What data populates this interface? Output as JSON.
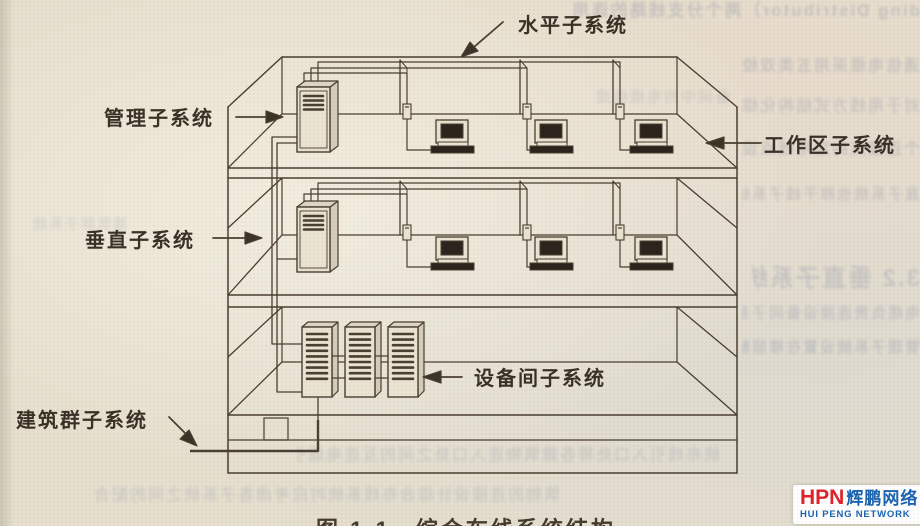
{
  "page": {
    "paper_color": "#e6dfce",
    "ink_color": "#4a3e31",
    "dark_fill": "#2b241c"
  },
  "diagram": {
    "caption": "图 1-1　综合布线系统结构",
    "labels": {
      "horizontal_subsystem": "水平子系统",
      "management_subsystem": "管理子系统",
      "work_area_subsystem": "工作区子系统",
      "vertical_subsystem": "垂直子系统",
      "equipment_room_subsystem": "设备间子系统",
      "campus_subsystem": "建筑群子系统"
    }
  },
  "watermark": {
    "abbr": "HPN",
    "name_cn": "辉鹏网络",
    "name_en": "HUI PENG NETWORK",
    "abbr_color": "#e0232a",
    "text_color": "#1b63b0"
  },
  "ghost_lines": [
    "ding Distributor）两个分支线路的连用",
    "通信电缆采用五类双绞线与配线区设备间连",
    "对于用线方式结构化综合布线系统的要求",
    "个连接点约定用线点设备间子系统由设",
    "3.2 垂直子系统",
    "直子系统也称干线子系统是建筑物内的主干",
    "电缆负责连接设备间子系统与楼层配线间",
    "管理子系统设置在楼层配线间是水平电缆汇",
    "备间中的电缆组成",
    "统布线引入口处将各建筑物连入口处之间的互连电缆引出建",
    "筑物的连接设计综合布线系统时应考虑各子系统之间的配合",
    "建筑群子系统"
  ]
}
